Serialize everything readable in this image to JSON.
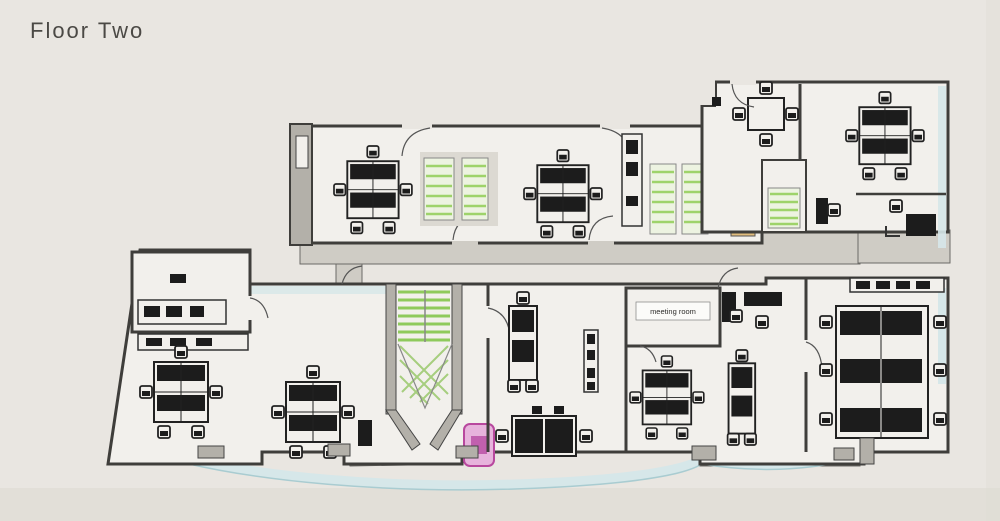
{
  "page": {
    "title": "Floor Two"
  },
  "plan": {
    "labels": {
      "meeting_room": "meeting room"
    },
    "colors": {
      "background": "#e9e6e1",
      "wall": "#3f3e3b",
      "wall_fill": "#b3b0a9",
      "floor": "#f2f0ec",
      "corridor": "#cfccc5",
      "furniture": "#1c1c1c",
      "stair_green": "#8fca5c",
      "shelf_green": "#9ed36a",
      "shelf_bg": "#edf3e1",
      "cabinet_tan": "#e2bd7d",
      "cabinet_tan_dark": "#7d551f",
      "glazing": "#d6e7e9",
      "glazing_line": "#a9ccd1",
      "accent_pink": "#e7b3dc",
      "accent_pink_dark": "#c160ae",
      "title_text": "#4b4945"
    }
  }
}
